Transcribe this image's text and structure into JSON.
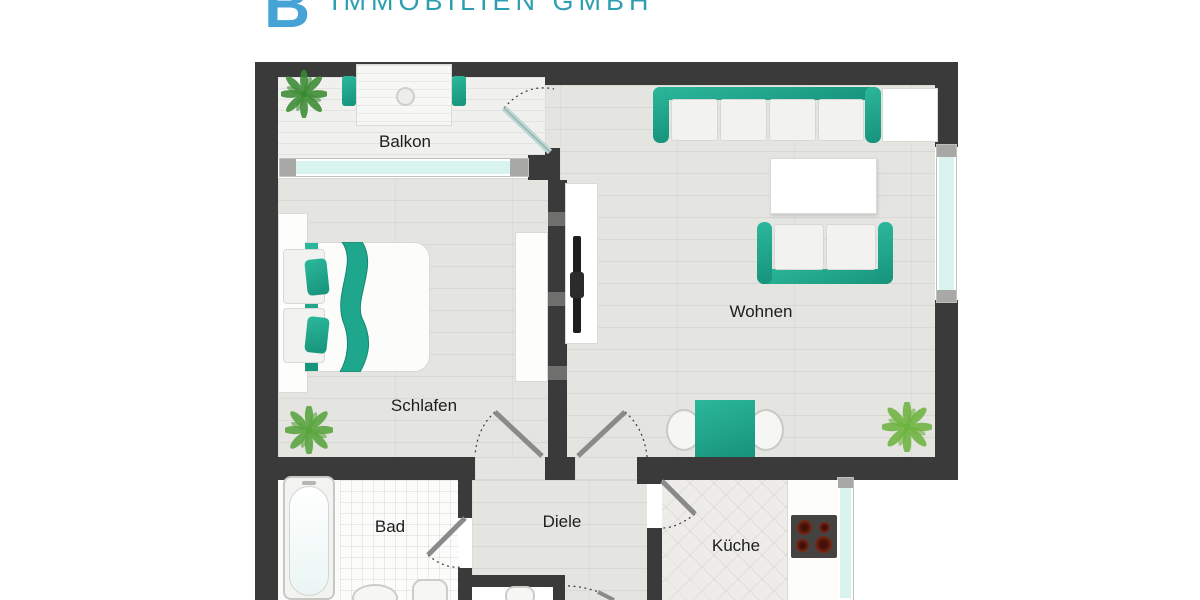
{
  "brand": {
    "initial": "B",
    "company": "IMMOBILIEN GMBH",
    "initial_color": "#45a3d6",
    "text_color": "#2d9fb0"
  },
  "labels": {
    "balkon": "Balkon",
    "schlafen": "Schlafen",
    "wohnen": "Wohnen",
    "bad": "Bad",
    "diele": "Diele",
    "kueche": "Küche"
  },
  "colors": {
    "wall": "#3a3a3a",
    "accent_teal": "#1fa78d",
    "window_glass": "#d9f3ef",
    "floor_wood": "#e4e4e1",
    "plant_green": "#58a33c",
    "stove_body": "#454341",
    "burner": "#6b2215"
  },
  "icons": {
    "plant": "plant-icon",
    "door_swing": "door-swing-arc",
    "stove": "four-burner-cooktop",
    "tv": "flatscreen-tv"
  }
}
